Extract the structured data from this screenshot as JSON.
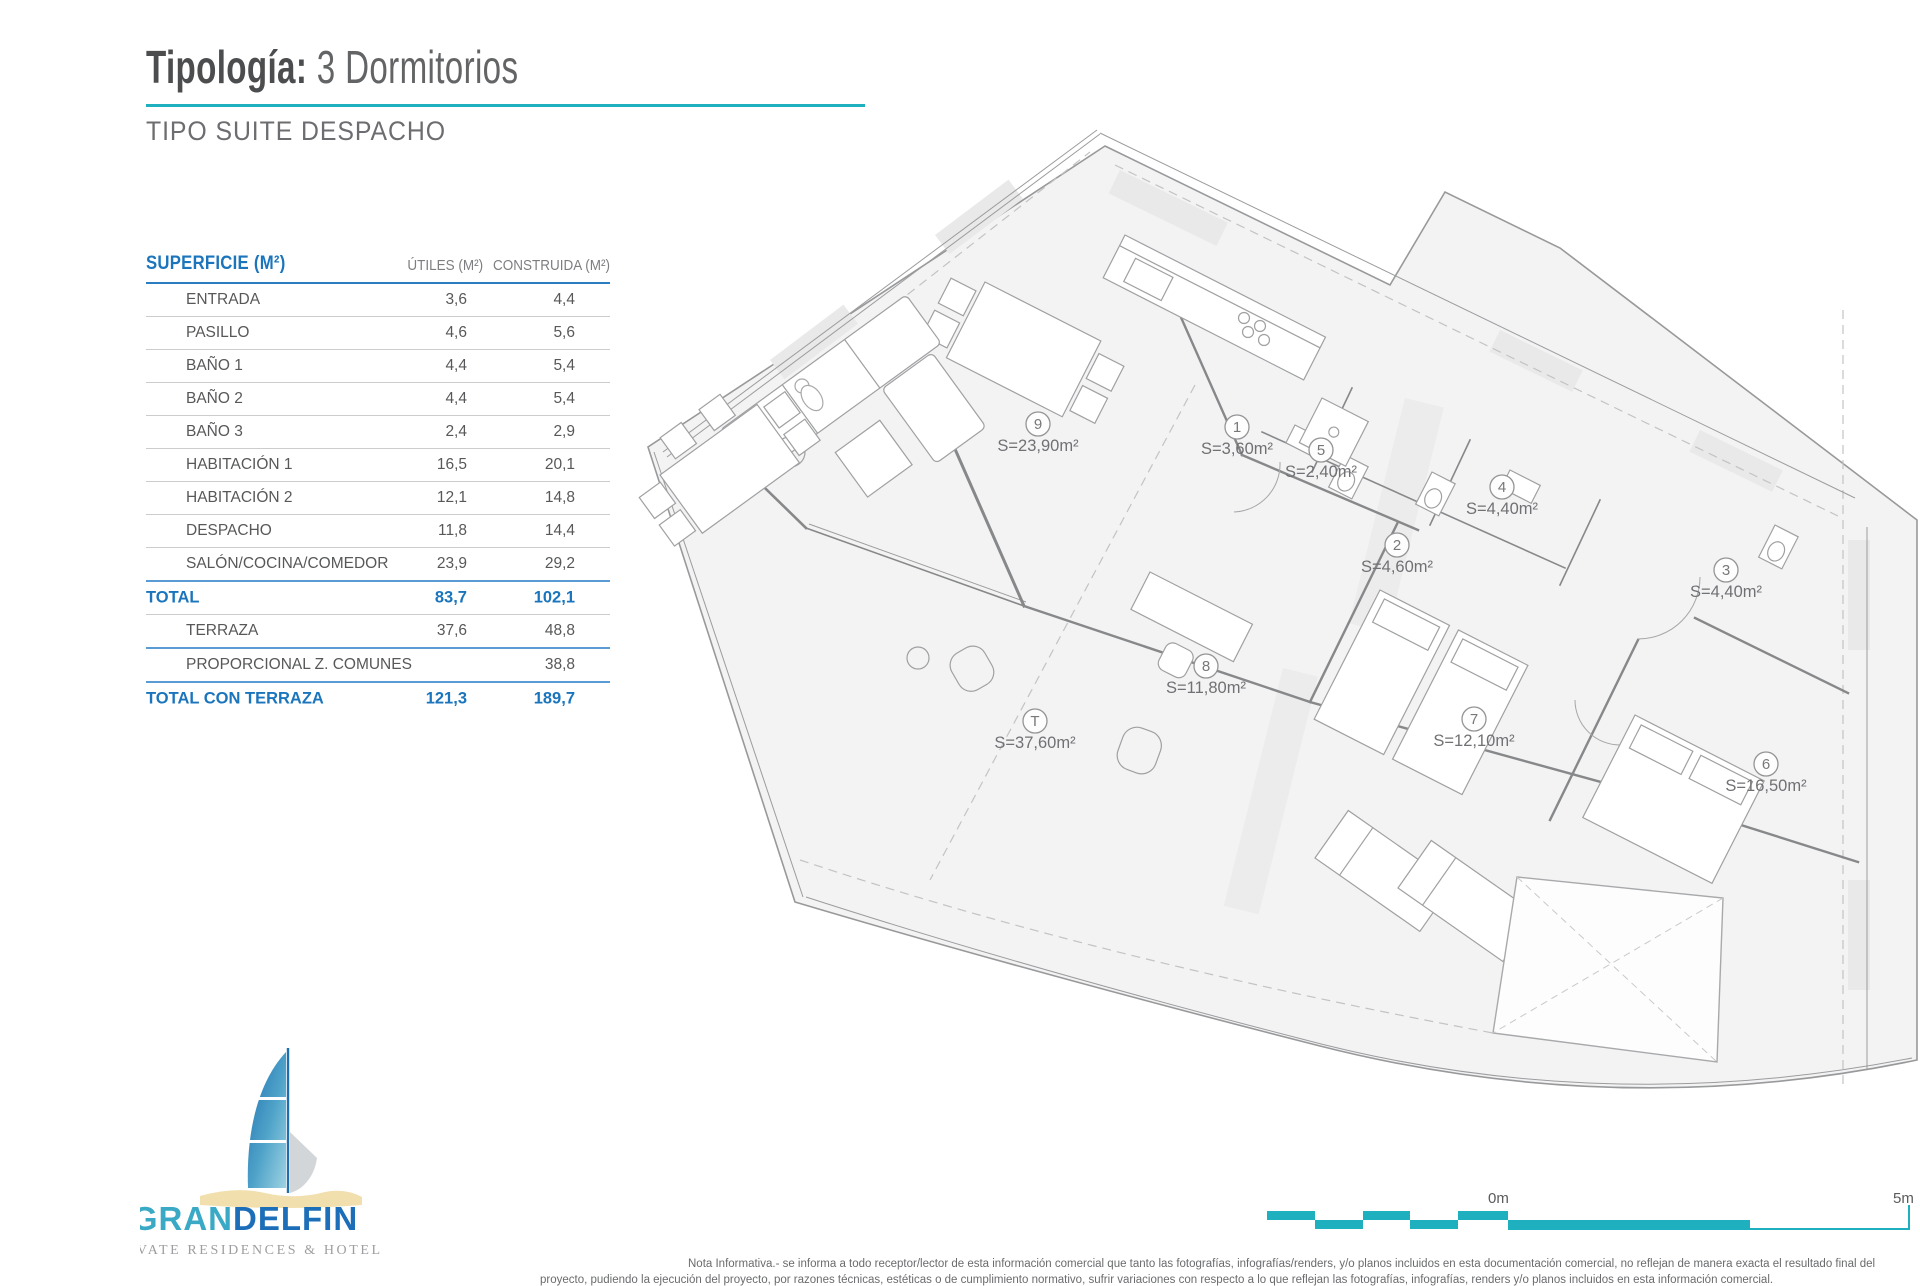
{
  "page": {
    "title_label": "Tipología:",
    "title_value": " 3 Dormitorios",
    "subtitle": "TIPO SUITE DESPACHO"
  },
  "table": {
    "header": {
      "col1": "SUPERFICIE (M²)",
      "col2": "ÚTILES (M²)",
      "col3": "CONSTRUIDA (M²)"
    },
    "rows": [
      {
        "label": "ENTRADA",
        "utiles": "3,6",
        "construida": "4,4",
        "emphasis": false,
        "sep": "gray"
      },
      {
        "label": "PASILLO",
        "utiles": "4,6",
        "construida": "5,6",
        "emphasis": false,
        "sep": "gray"
      },
      {
        "label": "BAÑO 1",
        "utiles": "4,4",
        "construida": "5,4",
        "emphasis": false,
        "sep": "gray"
      },
      {
        "label": "BAÑO 2",
        "utiles": "4,4",
        "construida": "5,4",
        "emphasis": false,
        "sep": "gray"
      },
      {
        "label": "BAÑO 3",
        "utiles": "2,4",
        "construida": "2,9",
        "emphasis": false,
        "sep": "gray"
      },
      {
        "label": "HABITACIÓN 1",
        "utiles": "16,5",
        "construida": "20,1",
        "emphasis": false,
        "sep": "gray"
      },
      {
        "label": "HABITACIÓN 2",
        "utiles": "12,1",
        "construida": "14,8",
        "emphasis": false,
        "sep": "gray"
      },
      {
        "label": "DESPACHO",
        "utiles": "11,8",
        "construida": "14,4",
        "emphasis": false,
        "sep": "gray"
      },
      {
        "label": "SALÓN/COCINA/COMEDOR",
        "utiles": "23,9",
        "construida": "29,2",
        "emphasis": false,
        "sep": "blue"
      },
      {
        "label": "TOTAL",
        "utiles": "83,7",
        "construida": "102,1",
        "emphasis": true,
        "sep": "gray"
      },
      {
        "label": "TERRAZA",
        "utiles": "37,6",
        "construida": "48,8",
        "emphasis": false,
        "sep": "blue"
      },
      {
        "label": "PROPORCIONAL Z. COMUNES",
        "utiles": "",
        "construida": "38,8",
        "emphasis": false,
        "sep": "blue"
      },
      {
        "label": "TOTAL CON TERRAZA",
        "utiles": "121,3",
        "construida": "189,7",
        "emphasis": true,
        "sep": "none"
      }
    ]
  },
  "plan": {
    "rooms": [
      {
        "id": "9",
        "area": "S=23,90m²"
      },
      {
        "id": "1",
        "area": "S=3,60m²"
      },
      {
        "id": "5",
        "area": "S=2,40m²"
      },
      {
        "id": "4",
        "area": "S=4,40m²"
      },
      {
        "id": "2",
        "area": "S=4,60m²"
      },
      {
        "id": "3",
        "area": "S=4,40m²"
      },
      {
        "id": "8",
        "area": "S=11,80m²"
      },
      {
        "id": "T",
        "area": "S=37,60m²"
      },
      {
        "id": "7",
        "area": "S=12,10m²"
      },
      {
        "id": "6",
        "area": "S=16,50m²"
      }
    ]
  },
  "logo": {
    "brand_primary": "GRAN",
    "brand_secondary": "DELFIN",
    "tagline": "PRIVATE RESIDENCES & HOTEL"
  },
  "scale_bar": {
    "start_label": "0m",
    "end_label": "5m"
  },
  "colors": {
    "accent_teal": "#1fb0bf",
    "brand_blue": "#1b75bc"
  },
  "footnote": {
    "line1": "Nota Informativa.- se informa a todo receptor/lector de esta información comercial que tanto las fotografías, infografías/renders, y/o planos incluidos en esta documentación comercial, no reflejan de manera exacta el resultado final del",
    "line2": "proyecto, pudiendo la ejecución del proyecto, por razones técnicas, estéticas o de cumplimiento normativo, sufrir variaciones con respecto a lo que reflejan las fotografías, infografías, renders y/o planos incluidos en esta información comercial."
  }
}
